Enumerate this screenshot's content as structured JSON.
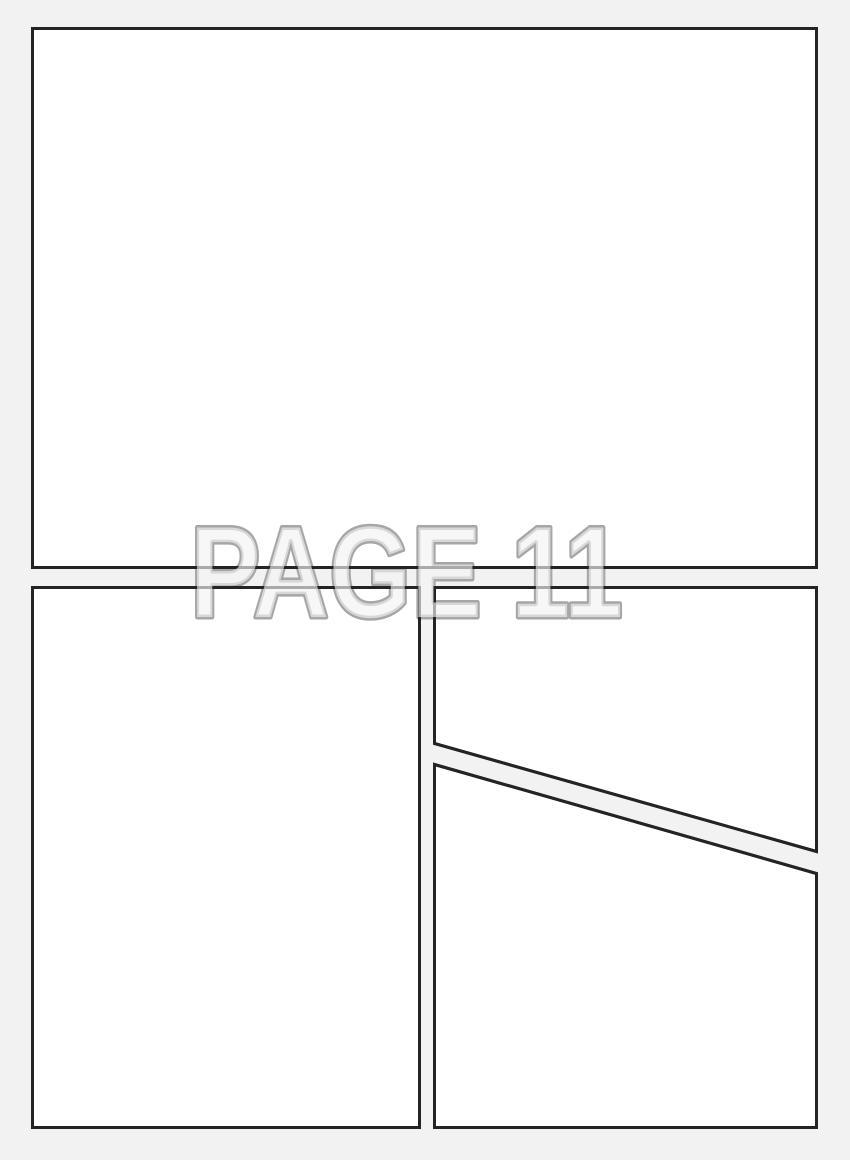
{
  "page": {
    "label": "PAGE 11",
    "panel_count": 4,
    "panels": [
      {
        "name": "top-full-width"
      },
      {
        "name": "bottom-left"
      },
      {
        "name": "middle-right"
      },
      {
        "name": "bottom-right"
      }
    ]
  },
  "colors": {
    "page_bg": "#f2f2f2",
    "panel_fill": "#ffffff",
    "panel_border": "#242424",
    "label_outline": "#a6a6a6",
    "label_fill": "rgba(242,242,242,0.65)"
  }
}
